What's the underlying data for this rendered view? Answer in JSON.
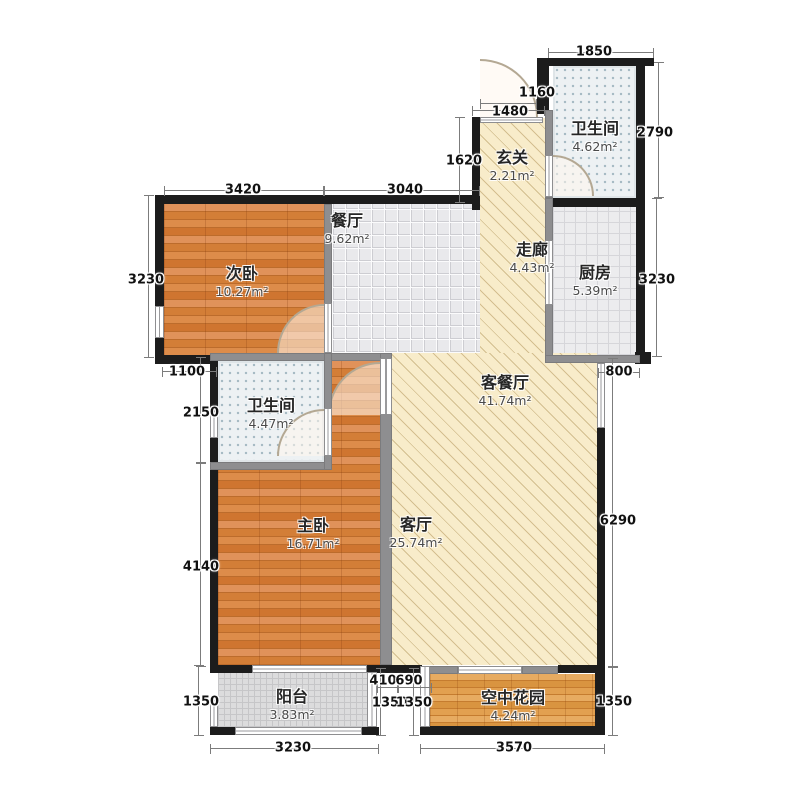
{
  "rooms": [
    {
      "name": "次卧",
      "area": "10.27m²"
    },
    {
      "name": "餐厅",
      "area": "9.62m²"
    },
    {
      "name": "玄关",
      "area": "2.21m²"
    },
    {
      "name": "卫生间",
      "area": "4.62m²"
    },
    {
      "name": "走廊",
      "area": "4.43m²"
    },
    {
      "name": "厨房",
      "area": "5.39m²"
    },
    {
      "name": "客餐厅",
      "area": "41.74m²"
    },
    {
      "name": "卫生间",
      "area": "4.47m²"
    },
    {
      "name": "主卧",
      "area": "16.71m²"
    },
    {
      "name": "客厅",
      "area": "25.74m²"
    },
    {
      "name": "阳台",
      "area": "3.83m²"
    },
    {
      "name": "空中花园",
      "area": "4.24m²"
    }
  ],
  "dims": [
    "1850",
    "1160",
    "1480",
    "1620",
    "3420",
    "3040",
    "2790",
    "3230",
    "800",
    "6290",
    "1350",
    "3230",
    "1100",
    "2150",
    "4140",
    "1350",
    "3230",
    "3570",
    "410",
    "690",
    "1350",
    "1350"
  ],
  "colors": {
    "wood": "#d5813c",
    "wood_light": "#dfa053",
    "tile_dining": "#e9e9ec",
    "tile_kitchen": "#ececee",
    "tile_bath": "#edf1f3",
    "tile_balcony": "#dcdcdd",
    "hatch_tan": "#f8ecca",
    "wall_exterior": "#1c1c1c",
    "wall_interior": "#8e8e90",
    "dimension_text": "#111111"
  }
}
